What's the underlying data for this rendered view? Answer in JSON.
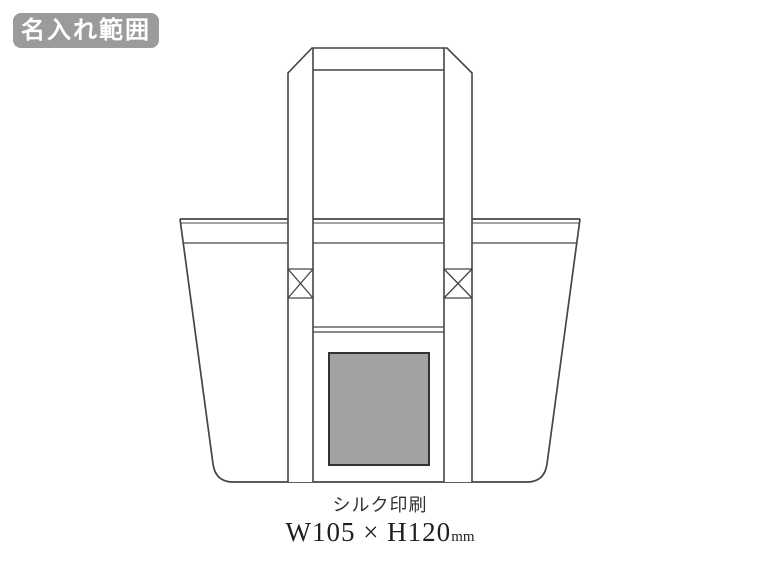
{
  "badge": {
    "label": "名入れ範囲"
  },
  "illustration": {
    "name": "tote-bag-front-line-drawing",
    "print_area_shape": "rectangle"
  },
  "caption": {
    "method": "シルク印刷",
    "dimensions": "W105 × H120",
    "unit": "mm"
  },
  "colors": {
    "badge_background": "#9b9b9b",
    "badge_text": "#ffffff",
    "line_art": "#454545",
    "print_area_fill": "#a2a2a2",
    "print_area_border": "#333333",
    "background": "#ffffff"
  }
}
